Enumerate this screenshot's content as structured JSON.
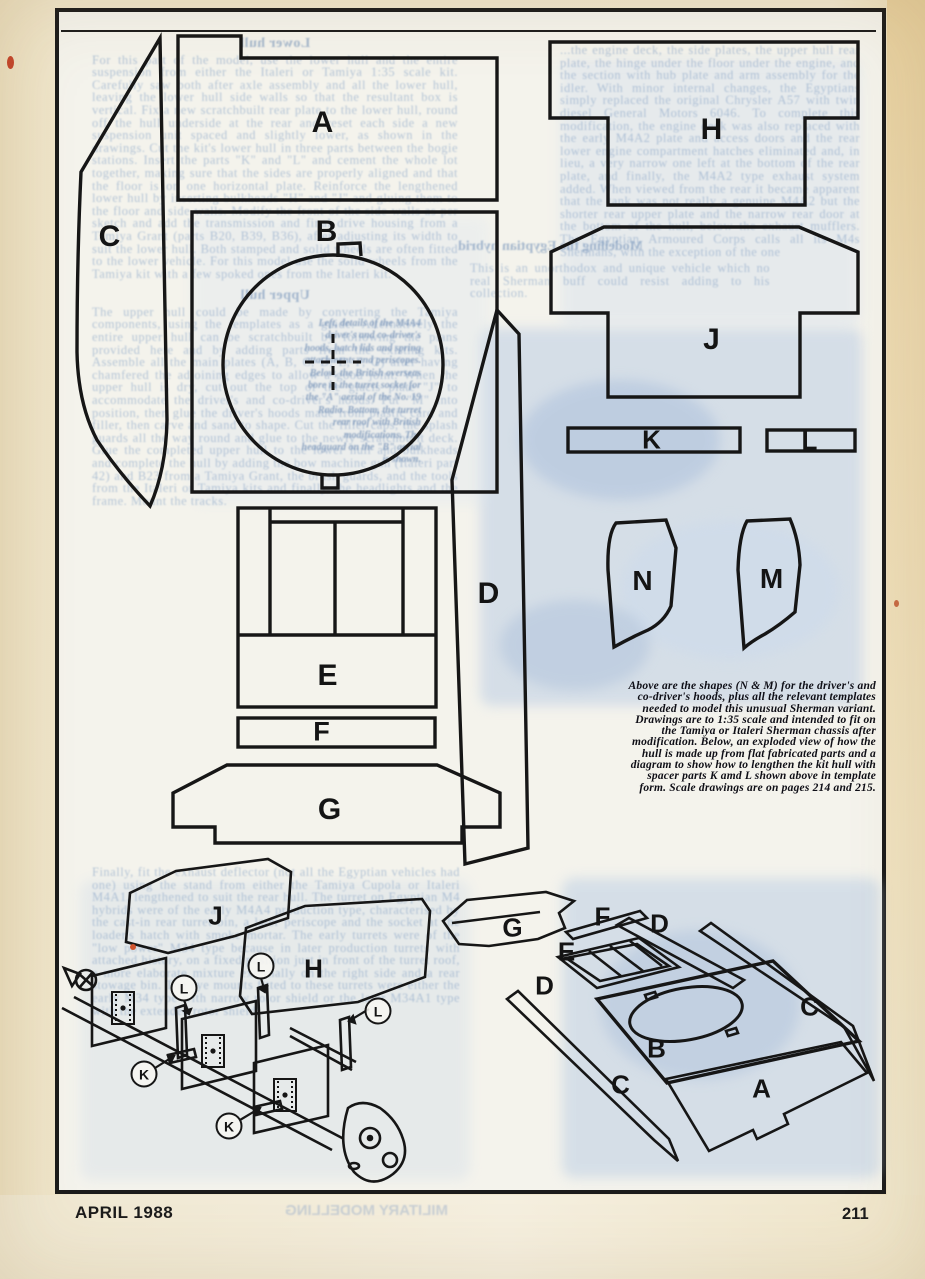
{
  "page": {
    "footer_left": "APRIL 1988",
    "footer_right": "211",
    "footer_ghost": "MILITARY MODELLING"
  },
  "caption": {
    "text": "Above are the shapes (N & M) for the driver's and co-driver's hoods, plus all the relevant templates needed to model this unusual Sherman variant. Drawings are to 1:35 scale and intended to fit on the Tamiya or Italeri Sherman chassis after modification. Below, an exploded view of how the hull is made up from flat fabricated parts and a diagram to show how to lengthen the kit hull with spacer parts K amd L shown above in template form. Scale drawings are on pages 214 and 215."
  },
  "labels": {
    "A": "A",
    "B": "B",
    "C": "C",
    "D": "D",
    "E": "E",
    "F": "F",
    "G": "G",
    "H": "H",
    "J": "J",
    "K": "K",
    "L": "L",
    "M": "M",
    "N": "N"
  },
  "diagram_left": {
    "plates": [
      "J",
      "H"
    ],
    "circled": [
      "L",
      "L",
      "L",
      "K",
      "K"
    ]
  },
  "diagram_right": {
    "labels": [
      "G",
      "F",
      "D",
      "E",
      "D",
      "C",
      "B",
      "C",
      "A"
    ]
  },
  "ghost": {
    "left_heading_1": "Lower hull",
    "left_col_1": "For this part of the model, use the lower hull and the entire suspension from either the Italeri or Tamiya 1:35 scale kit. Carefully saw both after axle assembly and all the lower hull, leaving the lower hull side walls so that the resultant box is vertical. Fix a new scratchbuilt rear plate to the lower hull, round off the hull underside at the rear and reset each side a new suspension unit spaced and slightly lower, as shown in the drawings. Cut the kit's lower hull in three parts between the bogie stations. Insert the parts \"K\" and \"L\" and cement the whole lot together, making sure that the sides are properly aligned and that the floor is on one horizontal plate. Reinforce the lengthened lower hull by inserting bulkheads \"H\" and \"J\" and gluing them to the floor and side walls. Modify the front of the side walls as per sketch and add the transmission and final drive housing from a Tamiya Grant (parts B20, B39, B36), after adjusting its width to suit the lower hull. Both stamped and solid wheels are often fitted to the lower vehicle. For this model use the solid wheels from the Tamiya kit with a few spoked ones from the Italeri kit.",
    "left_heading_2": "Upper hull",
    "left_col_2": "The upper hull could be made by converting the Tamiya components, using the templates as a guide. Alternatively the entire upper hull can be scratchbuilt by following the plans provided here and by adding parts from the existing kits. Assemble all the main plates (A, B, C, D, E, F, G) after having chamfered the adjoining edges to allow a good joint. When the upper hull is dry, cut out the top of the glacis plate \"J\" to accommodate the driver's and co-driver's hoods. Put \"M\" into position, then glue the driver's hoods made from plastic card and filler, then carve and sand to shape. Cut the filler caps, the splash guards all the way round and glue to the newly scratchbuilt deck. Glue the completed upper hull to the lower hull and bulkheads and complete the hull by adding the bow machine gun (Italeri part 42) and B23 from a Tamiya Grant, the brush guards, and the tools from the Italeri or Tamiya kits and finally, the headlights and the frame. Mount the tracks.",
    "right_col_1": "...the engine deck, the side plates, the upper hull rear plate, the hinge under the floor under the engine, and the section with hub plate and arm assembly for the idler. With minor internal changes, the Egyptians simply replaced the original Chrysler A57 with twin diesel General Motors 6046. To complete this modification, the engine deck was also replaced with the early M4A2 plate and access doors and the rear lower engine compartment hatches eliminated and, in lieu, a very narrow one left at the bottom of the rear plate, and finally, the M4A2 type exhaust system added. When viewed from the rear it became apparent that the tank was not really a genuine M4A2 but the shorter rear upper plate and the narrow rear door at the bottom of the hull, below the exhaust mufflers. The Egyptian Armoured Corps calls all its M4s Shermans, with the exception of the one",
    "mid_heading": "Modelling the Egyptian hybrid",
    "mid_para": "This is an unorthodox and unique vehicle which no real Sherman buff could resist adding to his collection.",
    "circle_caption": "Left, details of the M4A4 driver's and co-driver's hoods, hatch lids and spring attachments and periscopes. Below, the British overseas bore in the turret socket for the \"A\" aerial of the No. 19 Radio. Bottom, the turret rear roof with British modifications. The headguard on the \"B\" aerial is shown.",
    "bottom_left": "Finally, fit the exhaust deflector (not all the Egyptian vehicles had one) using the stand from either the Tamiya Cupola or Italeri M4A1, lengthened to suit the rear hull. The turret on Egyptian M4 hybrids were of the early M4A4 production type, characterised by the cast-in rear turret bin, a later periscope and the socket at the loader's hatch with smoke mortar. The early turrets were of the \"low power\" M34 type because in later production turrets with attached history, on a fixed position just in front of the turret roof, a more elaborate mixture externally on the right side and a rear stowage bin. The eye mounts fitted to these turrets were either the early M34 type with narrow rotor shield or the later M34A1 type with the extended rotor shield."
  },
  "colors": {
    "paper": "#efe5ca",
    "frame_ink": "#1b1b1b",
    "line_ink": "#161616",
    "ghost_blue": "#87a3c6",
    "patch_blue": "#b9cde4"
  }
}
